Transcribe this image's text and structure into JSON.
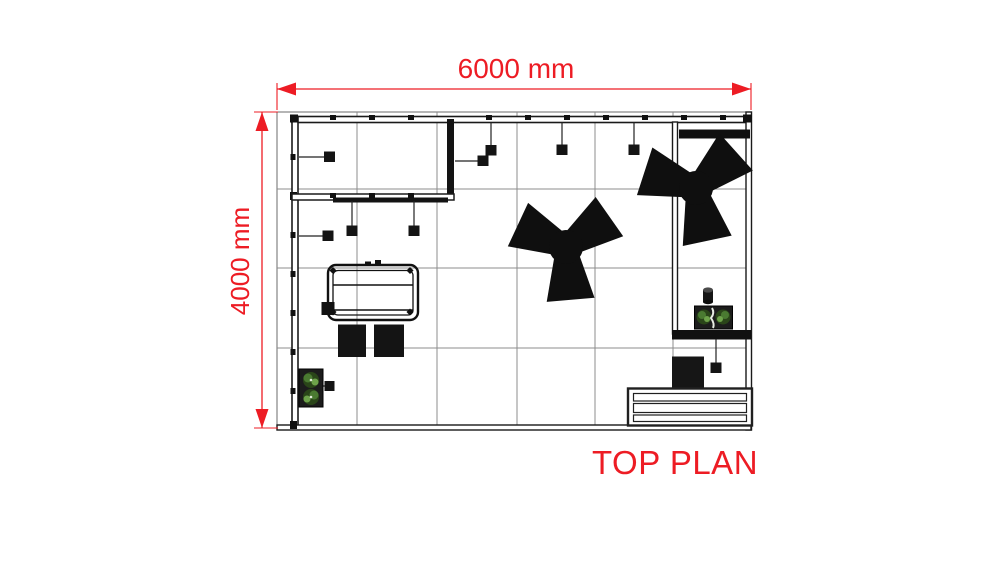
{
  "title": {
    "text": "TOP PLAN"
  },
  "dimensions": {
    "width": "6000 mm",
    "height": "4000 mm"
  },
  "colors": {
    "dimension_red": "#ed1c24",
    "wall_black": "#141414",
    "grid_gray": "#8c8c8c",
    "floor_edge_gray": "#6b6b6b",
    "plant_green_dark": "#2a4519",
    "plant_green_mid": "#4a7a31",
    "plant_green_light": "#6da24a",
    "background": "#ffffff"
  },
  "plan": {
    "grid": {
      "columns": 6,
      "rows": 4
    },
    "rooms": [
      "storage-room",
      "display-alcove"
    ],
    "furniture": [
      "meeting-table",
      "stool",
      "stool",
      "cube-seat",
      "reception-counter",
      "planter-left",
      "planter-right",
      "vase-cylinder",
      "y-lounge-structure",
      "y-lounge-structure"
    ],
    "light_count": 10
  }
}
